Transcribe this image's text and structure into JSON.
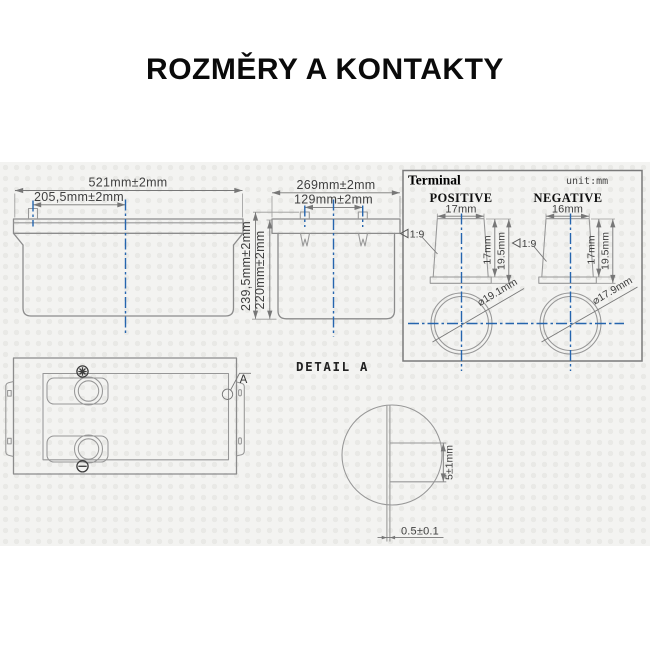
{
  "title": "ROZMĚRY A KONTAKTY",
  "colors": {
    "centerline_blue": "#2565ae",
    "outline_gray": "#8c8c8c",
    "dimension_text": "#3f3f3f",
    "background_texture": "#f3f3f1"
  },
  "front_view": {
    "width_dim": "521mm±2mm",
    "terminal_offset_dim": "205,5mm±2mm"
  },
  "side_view": {
    "width_dim": "269mm±2mm",
    "terminal_spacing_dim": "129mm±2mm",
    "total_height_dim": "239,5mm±2mm",
    "container_height_dim": "220mm±2mm"
  },
  "terminal_panel": {
    "title": "Terminal",
    "unit_label": "unit:mm",
    "positive": {
      "label": "POSITIVE",
      "top_width_dim": "17mm",
      "taper_label": "1:9",
      "taper_height_dim": "17mm",
      "total_height_dim": "19.5mm",
      "diameter_dim": "⌀19.1mm"
    },
    "negative": {
      "label": "NEGATIVE",
      "top_width_dim": "16mm",
      "taper_label": "1:9",
      "taper_height_dim": "17mm",
      "total_height_dim": "19.5mm",
      "diameter_dim": "⌀17.9mm"
    }
  },
  "top_view": {
    "detail_marker_label": "A",
    "positive_marker": "✳",
    "negative_marker": "⊖"
  },
  "detail_view": {
    "label": "DETAIL A",
    "step_height_dim": "5±1mm",
    "wall_thickness_dim": "0.5±0.1"
  }
}
